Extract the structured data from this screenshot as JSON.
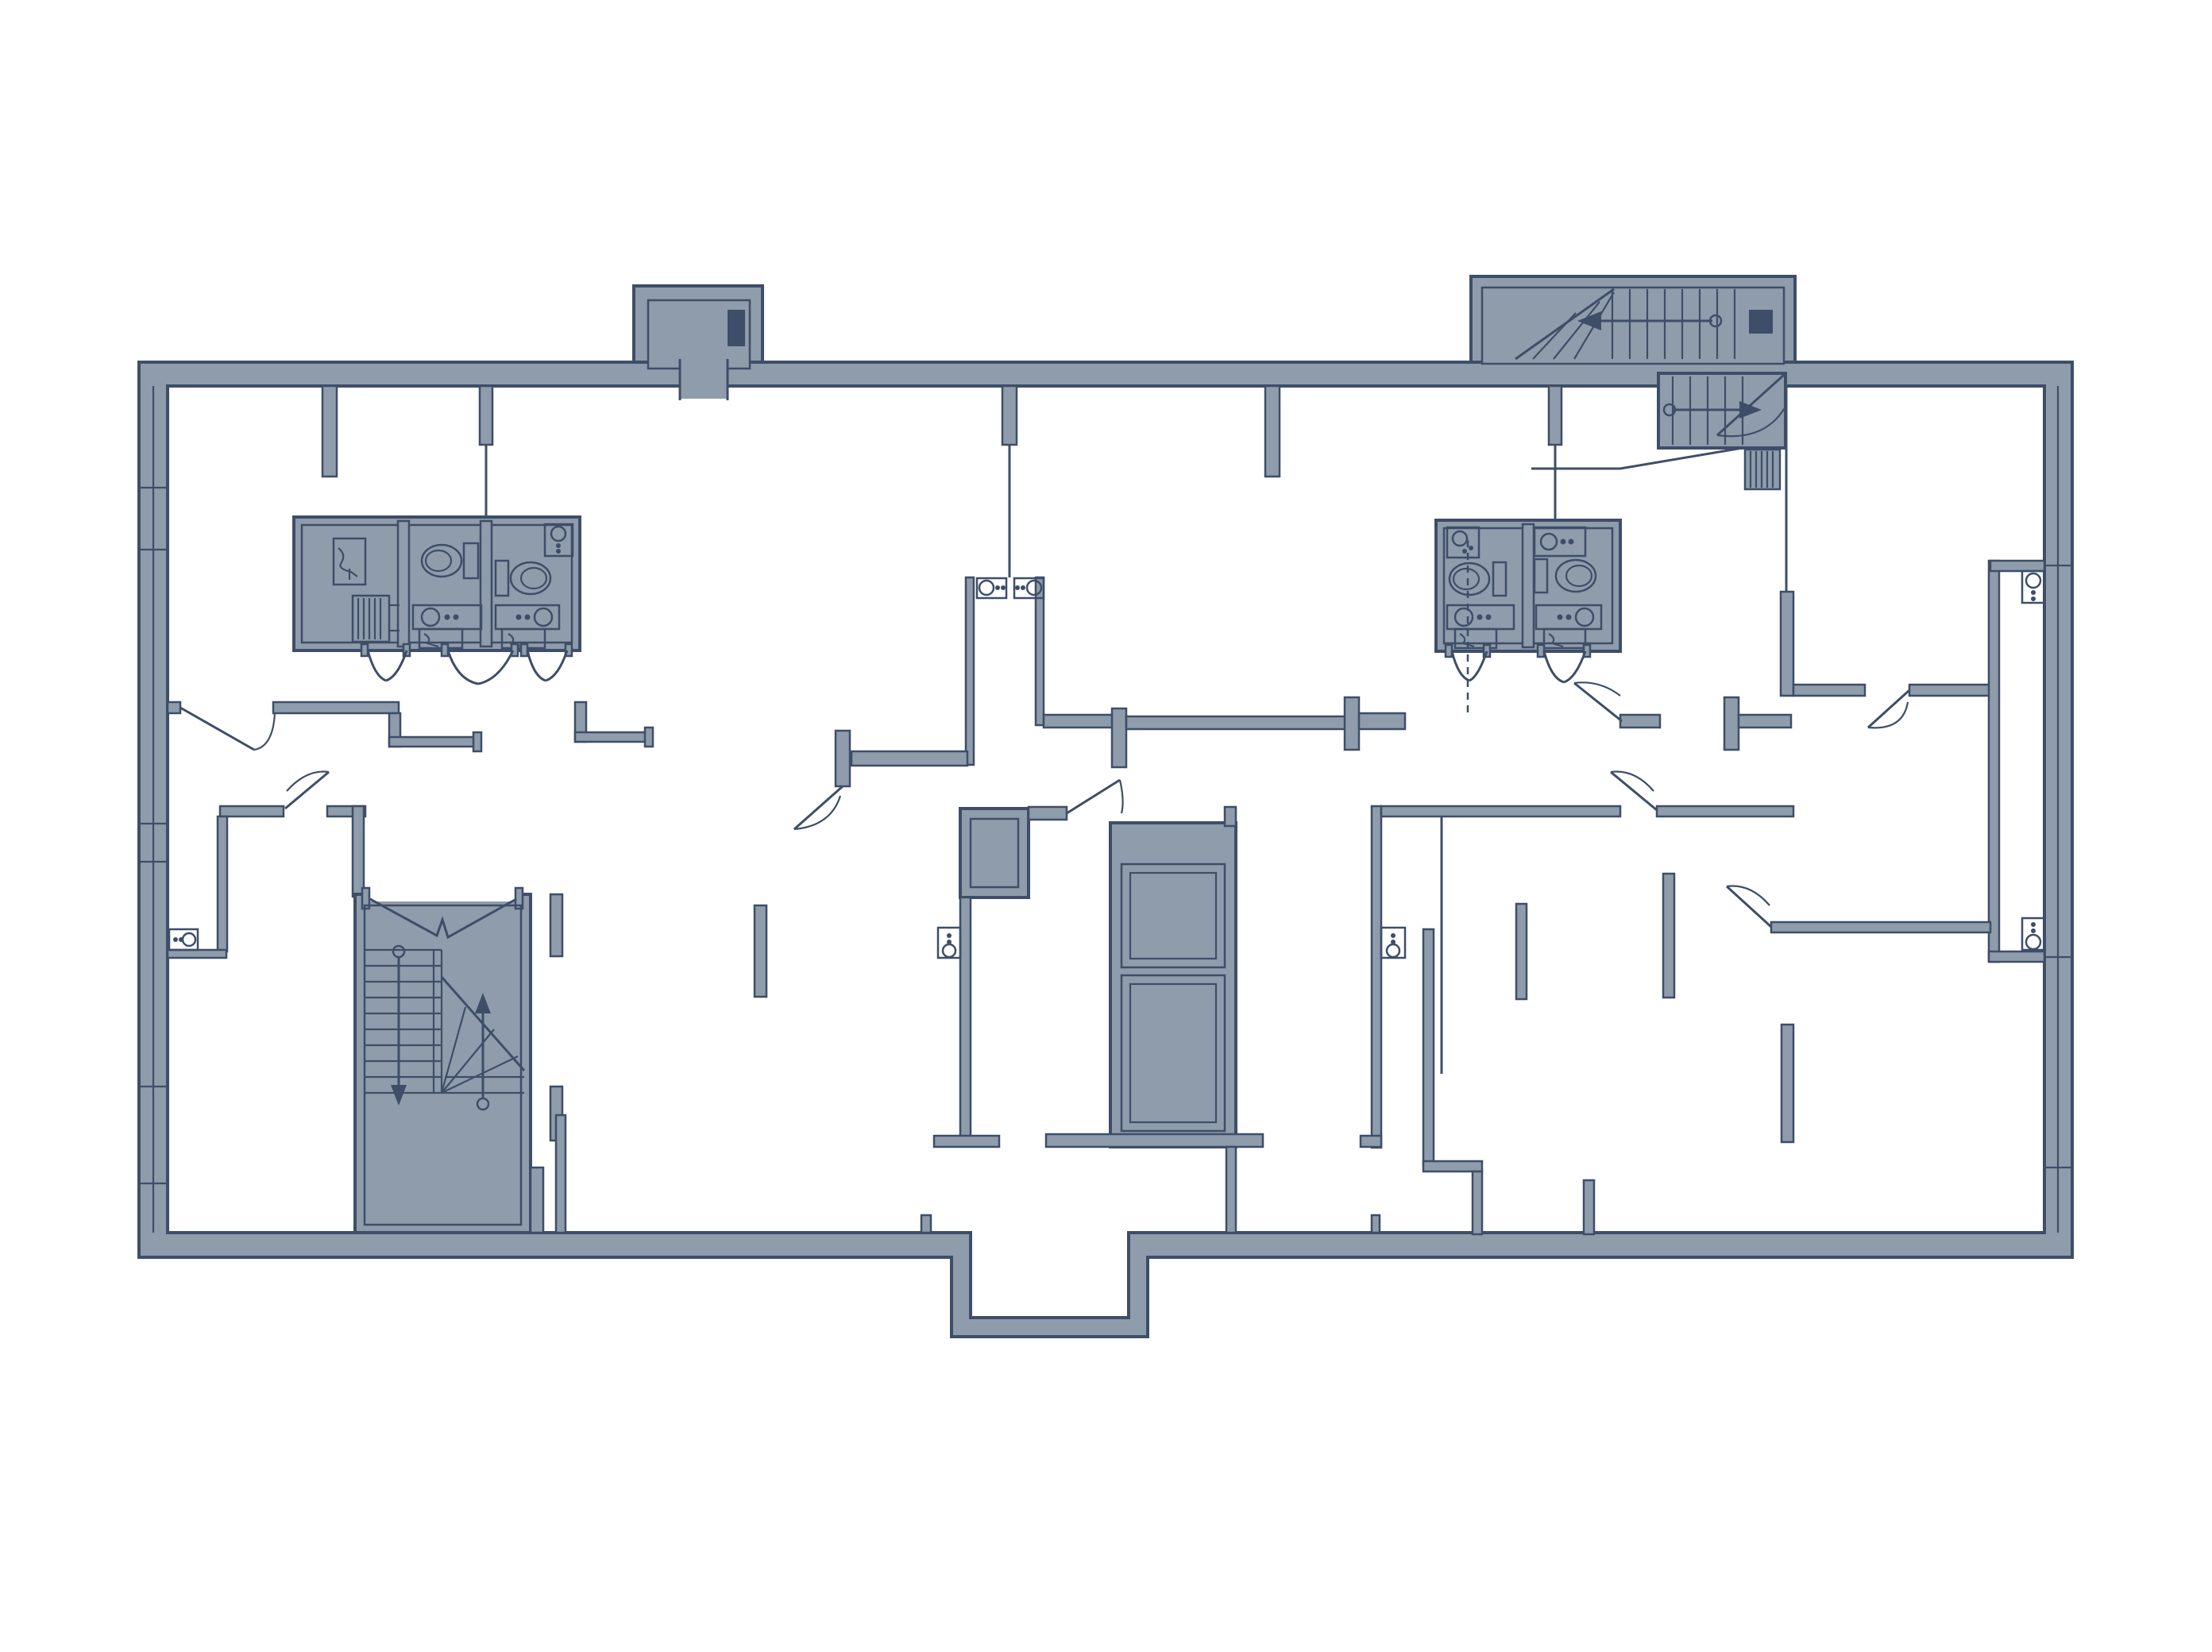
{
  "document": {
    "kind": "architectural-floor-plan",
    "page_background": "#ffffff",
    "visible_text": []
  },
  "colors": {
    "bg": "#ffffff",
    "wall": "#8f9cab",
    "ink": "#3e4e68",
    "dark": "#3e4e68"
  },
  "plan": {
    "features": [
      {
        "name": "exterior-wall-ring",
        "shape": "rectangular slab with south entrance vestibule"
      },
      {
        "name": "north-balcony-shaft",
        "side": "north-west top protrusion with inner duct"
      },
      {
        "name": "north-east-stairwell",
        "contents": [
          "upper flight with winder",
          "left arrow",
          "dark shaft square",
          "lower flight with right arrow",
          "door swing",
          "striped radiator"
        ]
      },
      {
        "name": "south-west-stairwell",
        "contents": [
          "double entry doors",
          "down flight",
          "up flight with winder",
          "landing"
        ]
      },
      {
        "name": "central-elevator-core",
        "contents": [
          "small shaft room",
          "two elevator cabs",
          "door swing",
          "side fixture"
        ]
      },
      {
        "name": "west-bathroom-pod",
        "rooms": 3,
        "fixtures": [
          "sink",
          "radiator",
          "toilet x2",
          "vanity x2",
          "basin x2"
        ],
        "doors": 3
      },
      {
        "name": "east-bathroom-pod",
        "rooms": 2,
        "fixtures": [
          "sink x2",
          "toilet x2",
          "vanity x2"
        ],
        "doors": 2,
        "extra": "dashed service line"
      },
      {
        "name": "central-vent-shaft",
        "fixtures": [
          "hob-sink unit x2"
        ]
      },
      {
        "name": "south-entrance-vestibule",
        "side": "south center protrusion"
      },
      {
        "name": "window-ticks-west-wall",
        "count": 6
      },
      {
        "name": "window-ticks-east-wall",
        "count": 3
      },
      {
        "name": "partition-stubs-north-wall",
        "count": 5
      },
      {
        "name": "wardrobe-bars",
        "count": 6
      },
      {
        "name": "door-swings",
        "count": 10
      }
    ]
  }
}
